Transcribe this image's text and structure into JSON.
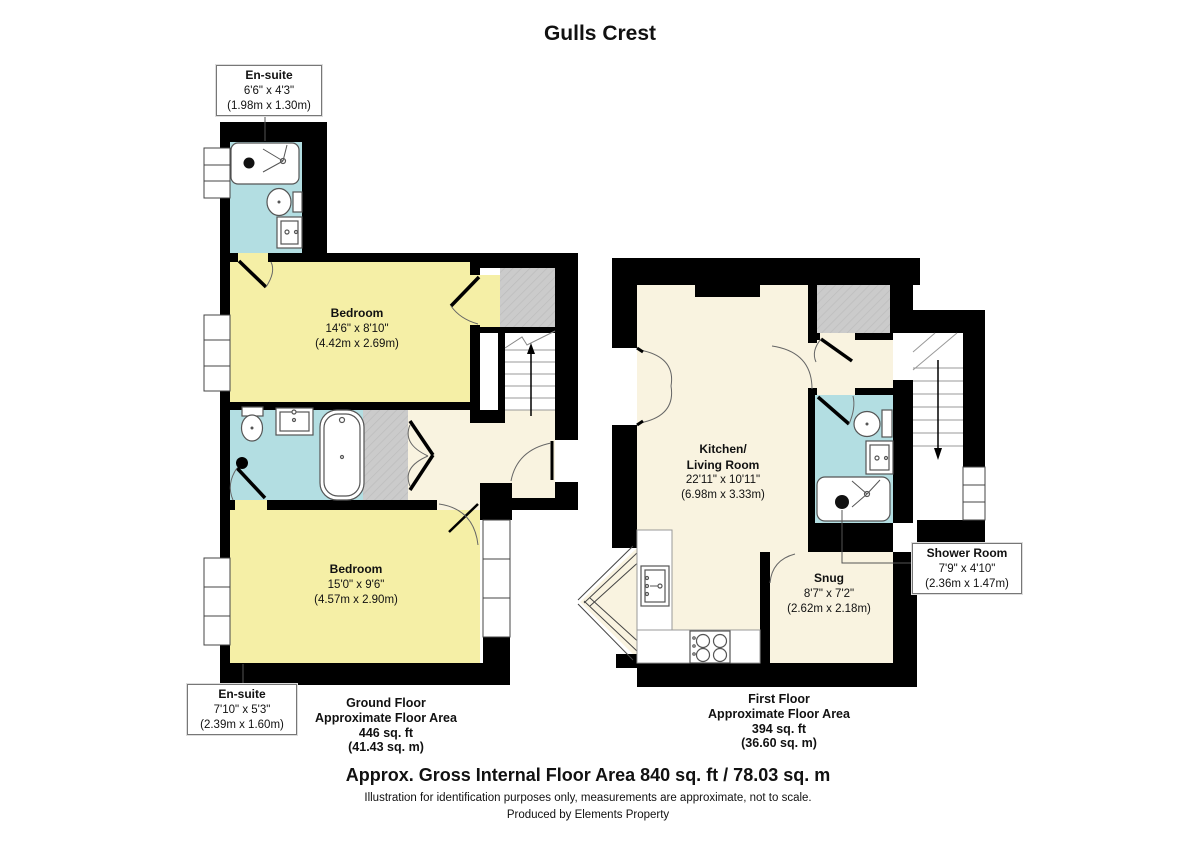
{
  "title": "Gulls Crest",
  "colors": {
    "wall": "#000000",
    "bedroom_fill": "#F5EFA6",
    "bathroom_fill": "#B3DEE2",
    "hall_fill": "#F9F3E0",
    "storage_fill": "#C9C9C9",
    "stairs_fill": "#FFFFFF"
  },
  "ground_floor": {
    "ensuite_top": {
      "name": "En-suite",
      "dims_ft": "6'6\" x 4'3\"",
      "dims_m": "(1.98m x 1.30m)"
    },
    "bedroom_top": {
      "name": "Bedroom",
      "dims_ft": "14'6\" x 8'10\"",
      "dims_m": "(4.42m x 2.69m)"
    },
    "bedroom_bottom": {
      "name": "Bedroom",
      "dims_ft": "15'0\" x 9'6\"",
      "dims_m": "(4.57m x 2.90m)"
    },
    "ensuite_bottom": {
      "name": "En-suite",
      "dims_ft": "7'10\" x 5'3\"",
      "dims_m": "(2.39m x 1.60m)"
    },
    "caption": [
      "Ground Floor",
      "Approximate Floor Area",
      "446 sq. ft",
      "(41.43 sq. m)"
    ]
  },
  "first_floor": {
    "kitchen_living": {
      "name1": "Kitchen/",
      "name2": "Living Room",
      "dims_ft": "22'11\" x 10'11\"",
      "dims_m": "(6.98m x 3.33m)"
    },
    "snug": {
      "name": "Snug",
      "dims_ft": "8'7\" x 7'2\"",
      "dims_m": "(2.62m x 2.18m)"
    },
    "shower_room": {
      "name": "Shower Room",
      "dims_ft": "7'9\" x 4'10\"",
      "dims_m": "(2.36m x 1.47m)"
    },
    "caption": [
      "First Floor",
      "Approximate Floor Area",
      "394 sq. ft",
      "(36.60 sq. m)"
    ]
  },
  "footer": {
    "total": "Approx. Gross Internal Floor Area 840 sq. ft / 78.03 sq. m",
    "disclaimer": "Illustration for identification purposes only, measurements are approximate, not to scale.",
    "credit": "Produced by Elements Property"
  }
}
